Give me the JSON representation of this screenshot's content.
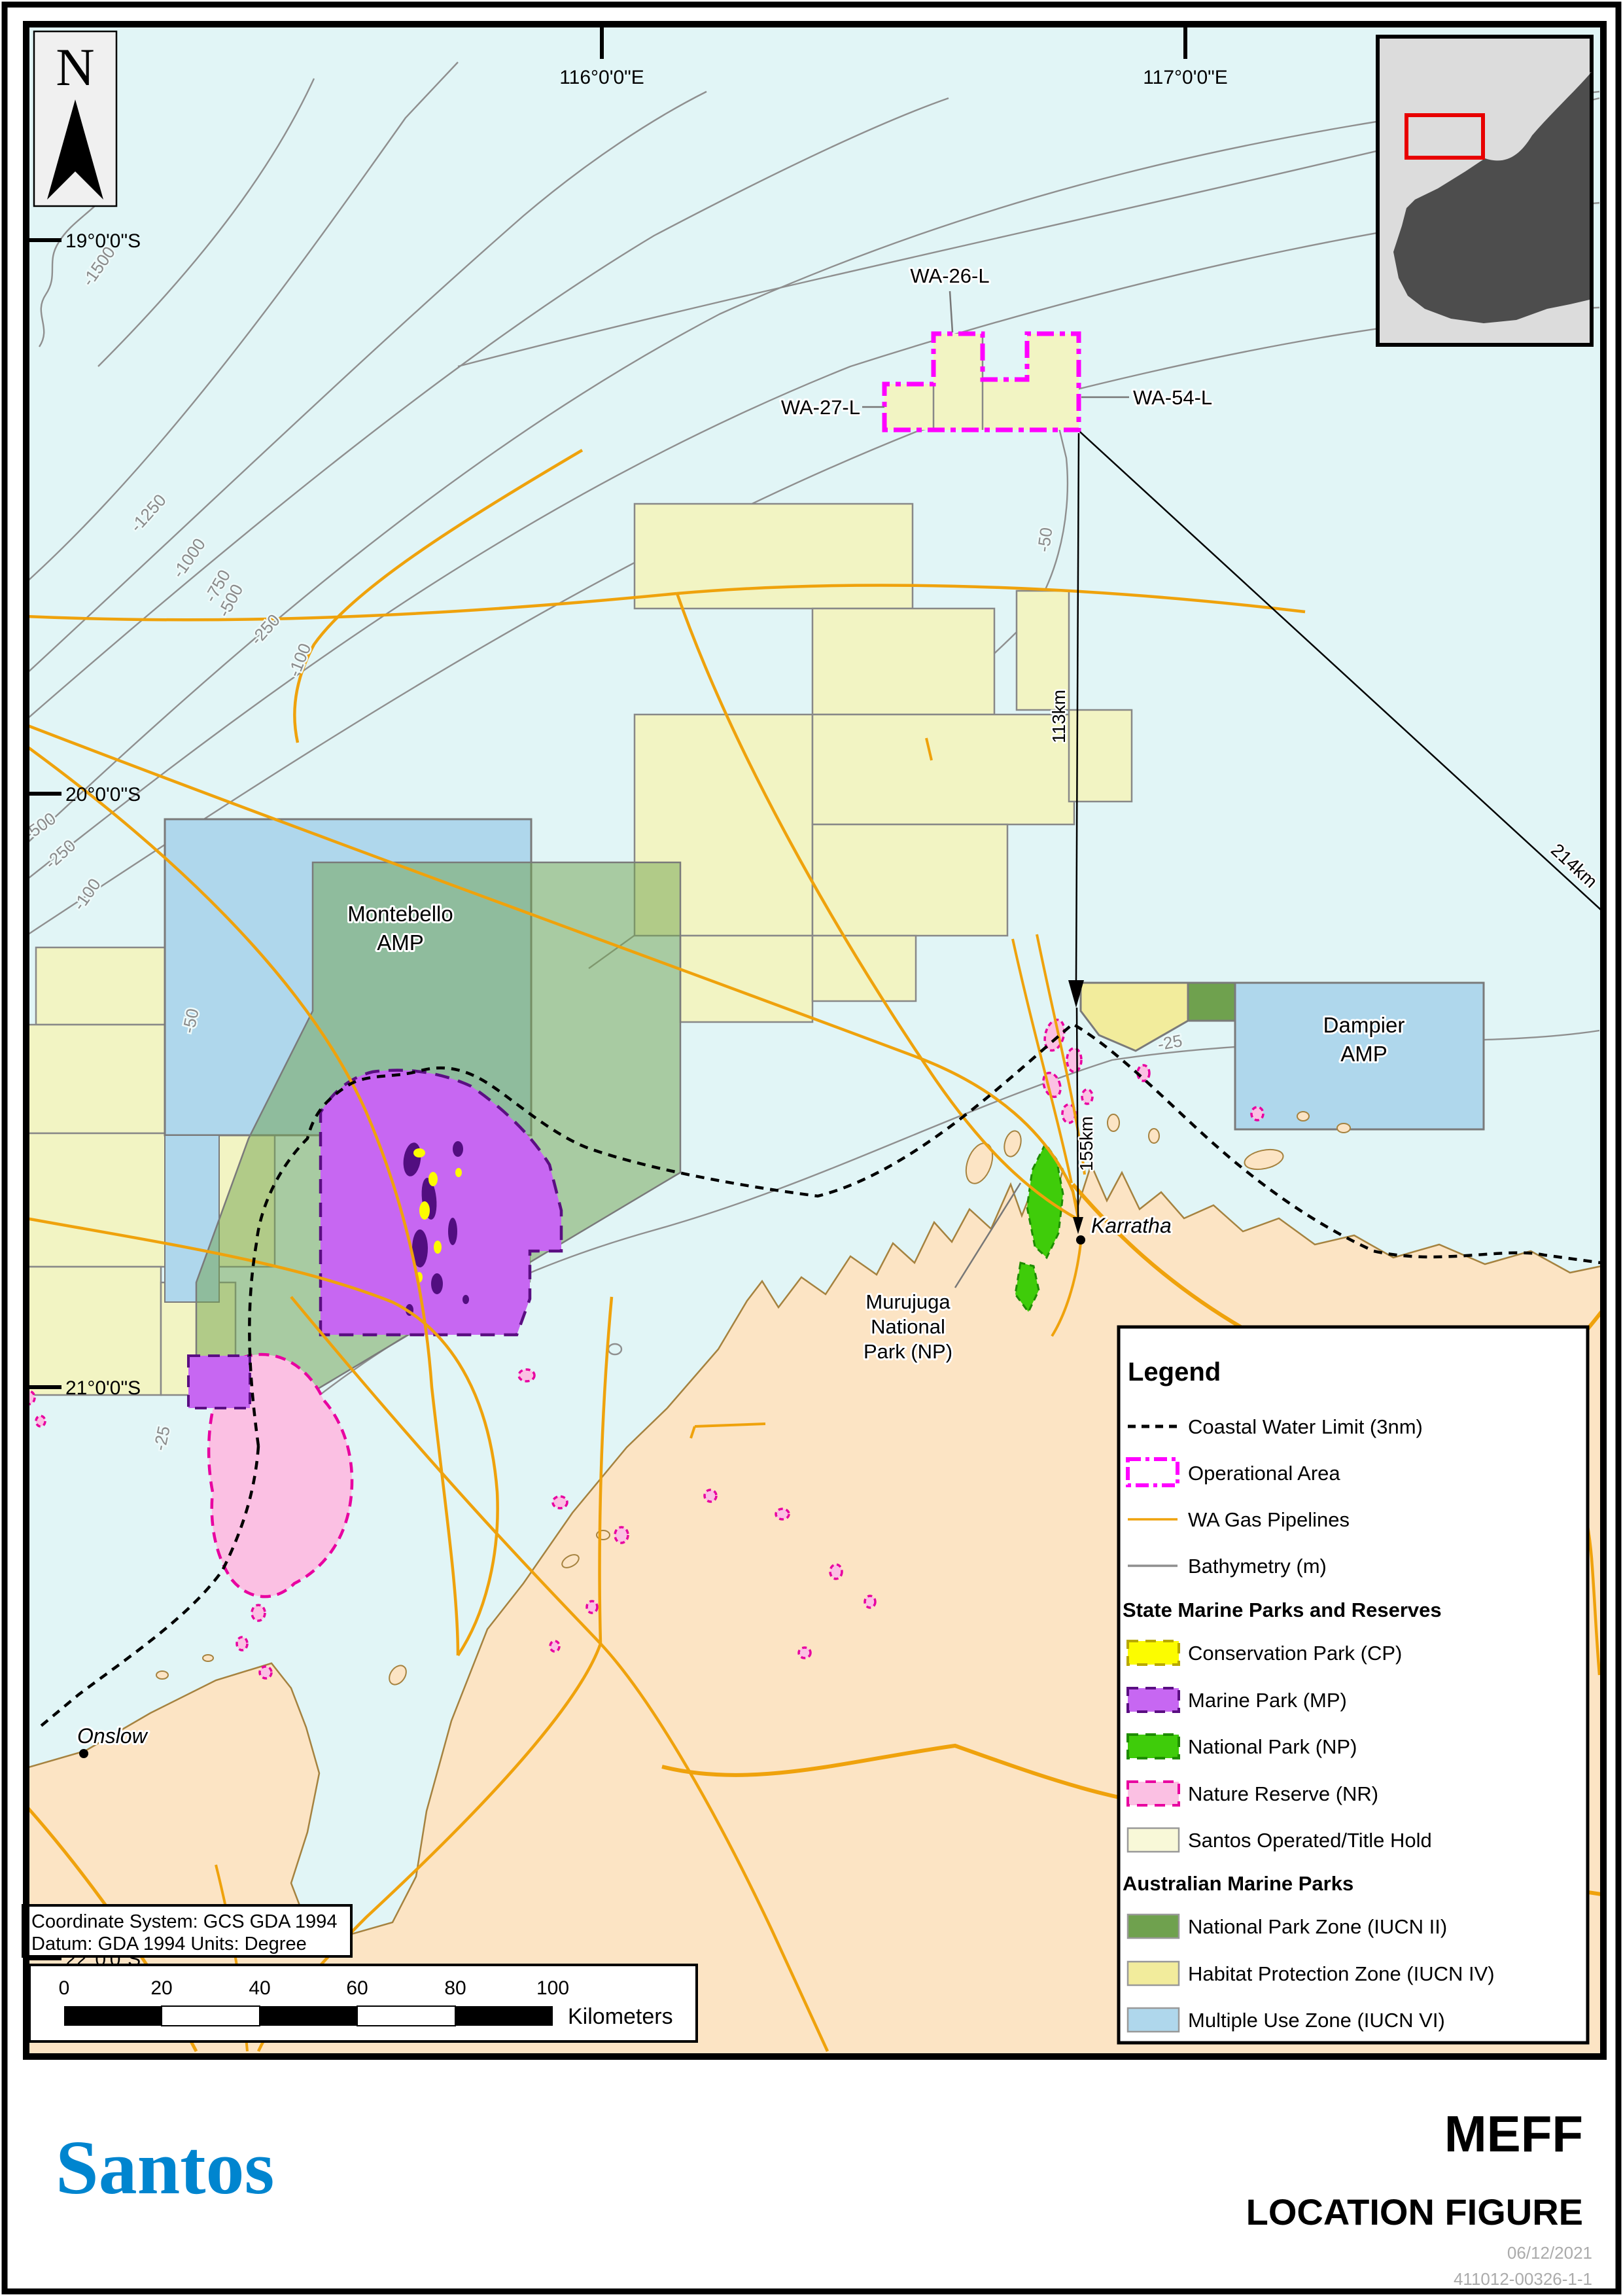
{
  "colors": {
    "sea": "#E1F5F6",
    "land": "#FCE4C4",
    "coastline": "#A5823F",
    "pipeline_orange": "#EFA20C",
    "bathymetry_gray": "#8F8F8F",
    "operational_magenta": "#FF00FF",
    "santos_title_fill": "#F2F4C3",
    "conservation_park_yellow": "#FCFC00",
    "marine_park_purple": "#C767F2",
    "national_park_green": "#3FCC0A",
    "nature_reserve_pink": "#FBC0E3",
    "nature_reserve_border": "#E800A0",
    "iucn2_green": "#6FA14E",
    "iucn4_yellow": "#F2EC9C",
    "iucn6_blue": "#AFD7EC",
    "coastal_limit_black": "#000000",
    "santos_logo_blue": "#0085CF",
    "inset_land_gray": "#4D4D4D",
    "inset_extent_red": "#E80000"
  },
  "north": {
    "label": "N"
  },
  "graticule": {
    "lon": [
      "116°0'0\"E",
      "117°0'0\"E"
    ],
    "lat": [
      "19°0'0\"S",
      "20°0'0\"S",
      "21°0'0\"S",
      "22°0'0\"S"
    ]
  },
  "bathy": {
    "m1500": "-1500",
    "m1250": "-1250",
    "m1000": "-1000",
    "m750": "-750",
    "m500": "-500",
    "m250": "-250",
    "m100": "-100",
    "m50": "-50",
    "m25": "-25"
  },
  "titles_blocks": {
    "wa26": "WA-26-L",
    "wa27": "WA-27-L",
    "wa54": "WA-54-L"
  },
  "distances": {
    "d113": "113km",
    "d155": "155km",
    "d214": "214km"
  },
  "places": {
    "montebello_line1": "Montebello",
    "montebello_line2": "AMP",
    "dampier_line1": "Dampier",
    "dampier_line2": "AMP",
    "karratha": "Karratha",
    "onslow": "Onslow",
    "murujuga_line1": "Murujuga",
    "murujuga_line2": "National",
    "murujuga_line3": "Park (NP)"
  },
  "legend": {
    "title": "Legend",
    "rows": [
      {
        "kind": "line",
        "label": "Coastal Water Limit (3nm)"
      },
      {
        "kind": "rect",
        "label": "Operational Area"
      },
      {
        "kind": "line",
        "label": "WA Gas Pipelines"
      },
      {
        "kind": "line",
        "label": "Bathymetry (m)"
      },
      {
        "kind": "header",
        "label": "State Marine Parks and Reserves"
      },
      {
        "kind": "swatch",
        "label": "Conservation Park (CP)"
      },
      {
        "kind": "swatch",
        "label": "Marine Park (MP)"
      },
      {
        "kind": "swatch",
        "label": "National Park (NP)"
      },
      {
        "kind": "swatch",
        "label": "Nature Reserve (NR)"
      },
      {
        "kind": "swatch",
        "label": "Santos Operated/Title Hold"
      },
      {
        "kind": "header",
        "label": "Australian Marine Parks"
      },
      {
        "kind": "swatch",
        "label": "National Park Zone (IUCN II)"
      },
      {
        "kind": "swatch",
        "label": "Habitat Protection Zone (IUCN IV)"
      },
      {
        "kind": "swatch",
        "label": "Multiple Use Zone (IUCN VI)"
      }
    ]
  },
  "scalebar": {
    "ticks": [
      "0",
      "20",
      "40",
      "60",
      "80",
      "100"
    ],
    "unit": "Kilometers"
  },
  "coordbox": {
    "line1": "Coordinate System: GCS GDA 1994",
    "line2": "Datum: GDA 1994  Units: Degree"
  },
  "titleblock": {
    "logo": "Santos",
    "title": "MEFF",
    "subtitle": "LOCATION FIGURE",
    "date": "06/12/2021",
    "docnum": "411012-00326-1-1"
  }
}
